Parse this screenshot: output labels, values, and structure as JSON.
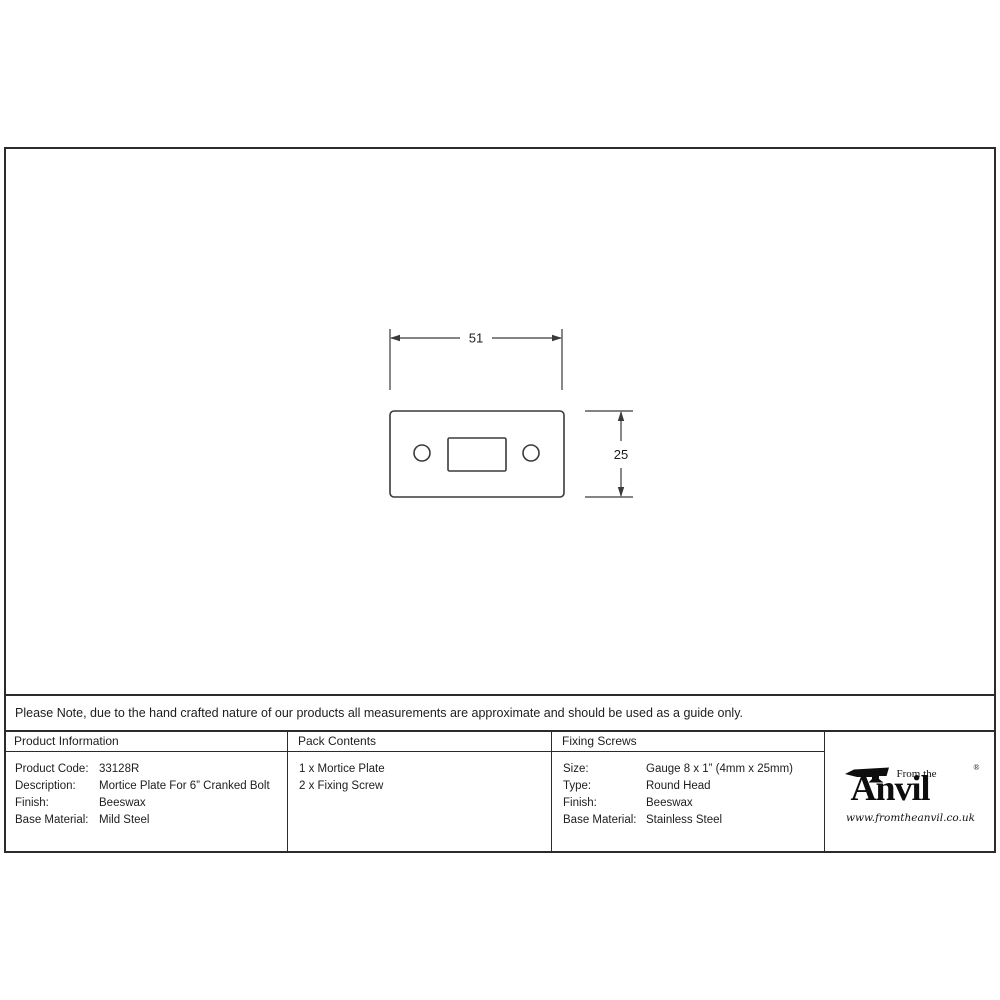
{
  "drawing": {
    "width_label": "51",
    "height_label": "25"
  },
  "note": {
    "text": "Please Note, due to the hand crafted nature of our products all measurements are approximate and should be used as a guide only."
  },
  "table": {
    "product_information": {
      "header": "Product Information",
      "rows": [
        {
          "label": "Product Code:",
          "value": "33128R"
        },
        {
          "label": "Description:",
          "value": "Mortice Plate For 6” Cranked Bolt"
        },
        {
          "label": "Finish:",
          "value": "Beeswax"
        },
        {
          "label": "Base Material:",
          "value": "Mild Steel"
        }
      ]
    },
    "pack_contents": {
      "header": "Pack Contents",
      "items": [
        "1 x Mortice Plate",
        "2 x Fixing Screw"
      ]
    },
    "fixing_screws": {
      "header": "Fixing Screws",
      "rows": [
        {
          "label": "Size:",
          "value": "Gauge 8 x 1” (4mm x 25mm)"
        },
        {
          "label": "Type:",
          "value": "Round Head"
        },
        {
          "label": "Finish:",
          "value": "Beeswax"
        },
        {
          "label": "Base Material:",
          "value": "Stainless Steel"
        }
      ]
    }
  },
  "logo": {
    "prefix": "From the",
    "name": "Anvil",
    "registered": "®",
    "url": "www.fromtheanvil.co.uk"
  },
  "colors": {
    "line": "#2b2b2b",
    "text": "#1d1d1d",
    "background": "#ffffff"
  }
}
